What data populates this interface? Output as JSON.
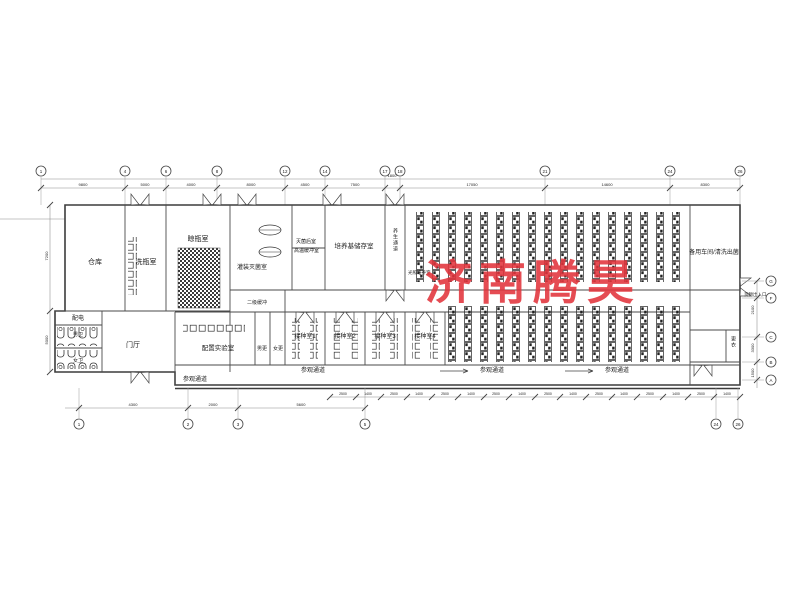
{
  "sheet": {
    "background": "#ffffff",
    "line_color": "#3c3c3c"
  },
  "watermark": {
    "text": "济南腾昊",
    "color": "#e2343c"
  },
  "rooms": {
    "warehouse": "仓库",
    "bottle_washing": "洗瓶室",
    "bottle_drying": "晾瓶室",
    "filling_sterilization": "灌装灭菌室",
    "post_sterilization": "灭菌后室",
    "high_temp_buffer": "高温缓冲室",
    "medium_storage": "培养基储存室",
    "incubation_corridor": "养生通道",
    "light_culture": "光照培养室",
    "spare_workshop": "备用车间/清洗出菌",
    "power": "配电",
    "mens_wc": "男卫",
    "womens_wc": "女卫",
    "lobby": "门厅",
    "prep_lab": "配置实验室",
    "secondary_buffer": "二级缓冲",
    "mens_change": "男更",
    "womens_change": "女更",
    "inoculation1": "接种室1",
    "inoculation2": "接种室2",
    "inoculation3": "接种室3",
    "inoculation4": "接种室4",
    "changing": "更衣",
    "cargo_door": "货物出入口",
    "visit_corridor": "参观通道"
  },
  "grid": {
    "top": [
      "1",
      "4",
      "6",
      "8",
      "12",
      "14",
      "17",
      "18",
      "21",
      "24",
      "26"
    ],
    "bottom": [
      "1",
      "2",
      "3",
      "5",
      "24",
      "26"
    ],
    "right": [
      "G",
      "F",
      "C",
      "B",
      "A"
    ]
  },
  "dims": {
    "top": [
      "9800",
      "5000",
      "4000",
      "8000",
      "4500",
      "7500",
      "1800",
      "17050",
      "14600",
      "8300"
    ],
    "bottom": [
      "4300",
      "2000",
      "5600"
    ],
    "ticks": [
      "2500",
      "1400",
      "2500",
      "1400",
      "2500",
      "1400",
      "2500",
      "1400",
      "2500",
      "1400",
      "2500",
      "1400",
      "2500",
      "1400",
      "2500",
      "1400"
    ],
    "left": [
      "7200",
      "5000"
    ],
    "right": [
      "2100",
      "3300",
      "1500"
    ]
  }
}
